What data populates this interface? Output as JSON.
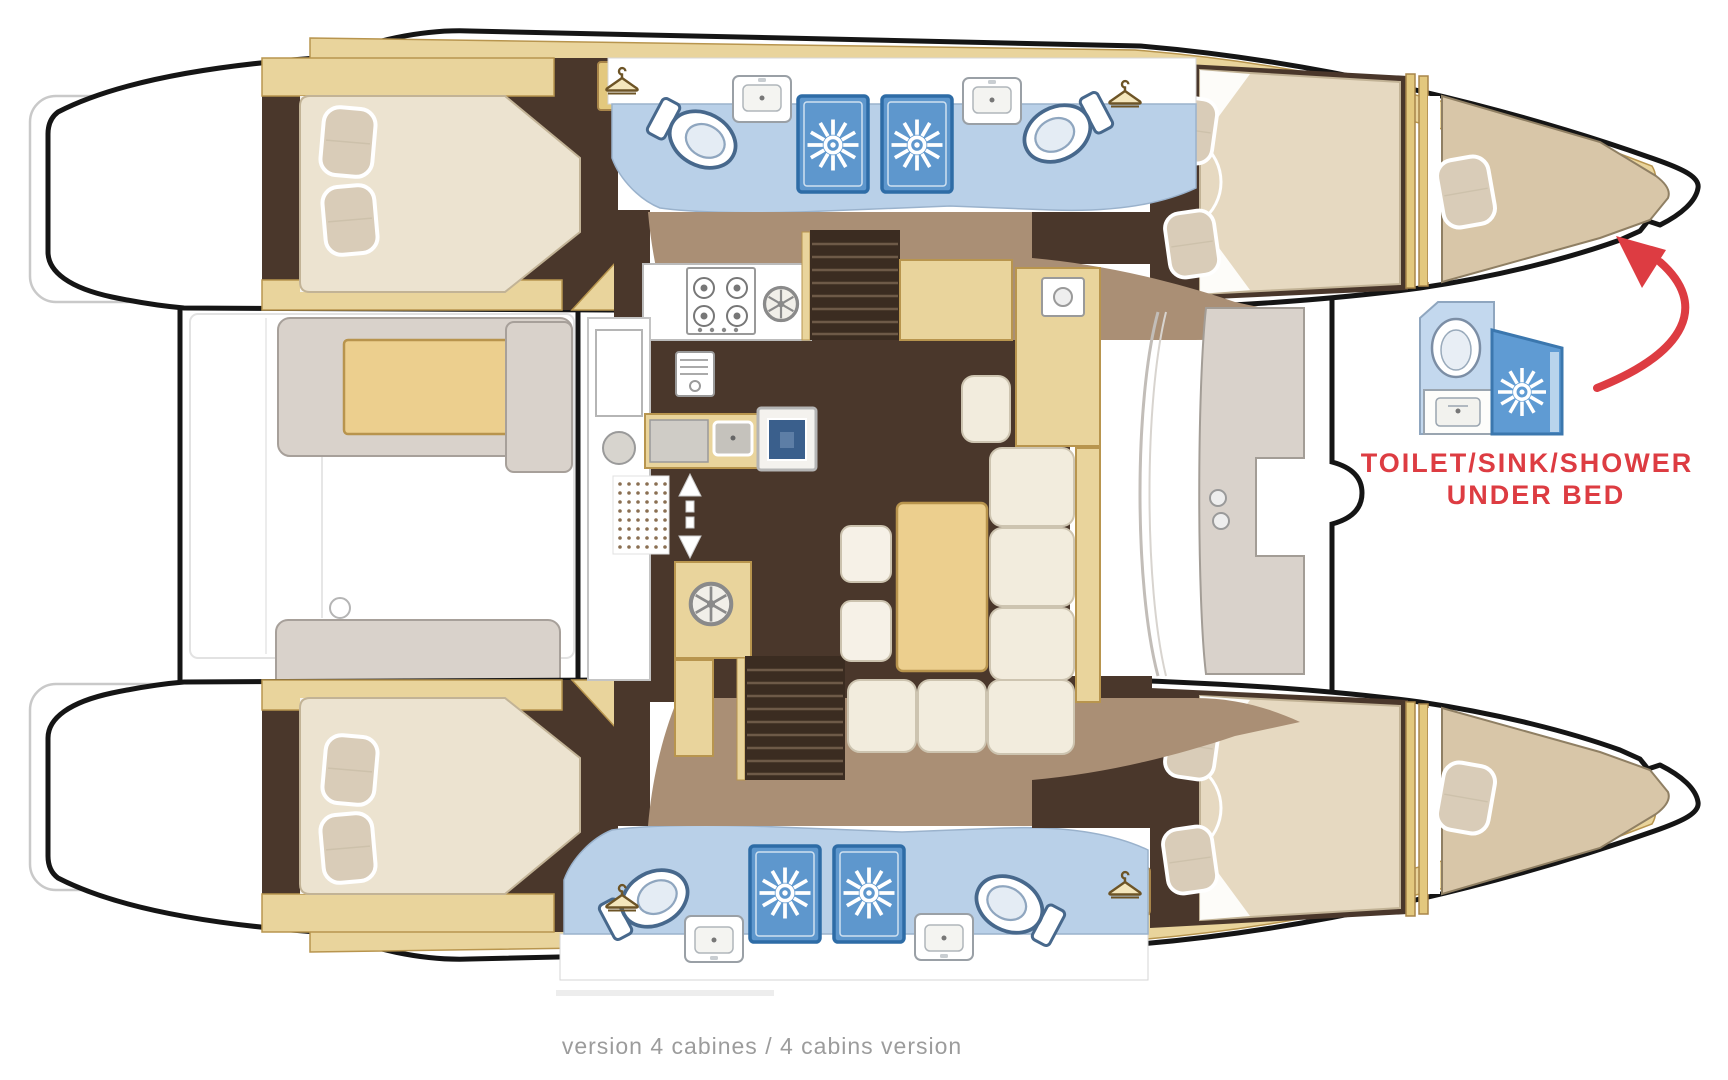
{
  "diagram": {
    "type": "catamaran-floor-plan",
    "annotation": {
      "line1": "TOILET/SINK/SHOWER",
      "line2": "UNDER BED",
      "color": "#dd3c42"
    },
    "caption": {
      "text": "version 4 cabines / 4 cabins version",
      "color": "#9c9c9c"
    },
    "palette": {
      "hull_outline": "#151515",
      "wood_trim": "#e9d49c",
      "wood_trim_edge": "#b8954e",
      "floor_dark_brown": "#4a372b",
      "floor_light_brown": "#aa8f75",
      "stairs_brown": "#3b2c21",
      "bed_cream": "#ece3d0",
      "bed_beige": "#d8c6a8",
      "pillow": "#d9ccb8",
      "bathroom_blue": "#b9d0e8",
      "shower_blue": "#5e97cd",
      "shower_frame": "#2e6ca6",
      "deck_gray": "#d9d2cb",
      "accent_red": "#dd3c42"
    },
    "icons": [
      "hanger-icon",
      "shower-drain-icon",
      "toilet-icon",
      "sink-icon",
      "stove-icon",
      "burner-wheel-icon",
      "vent-fan-icon",
      "oven-icon",
      "companionway-arrow-icon",
      "stairs-icon",
      "curved-arrow-icon"
    ]
  }
}
